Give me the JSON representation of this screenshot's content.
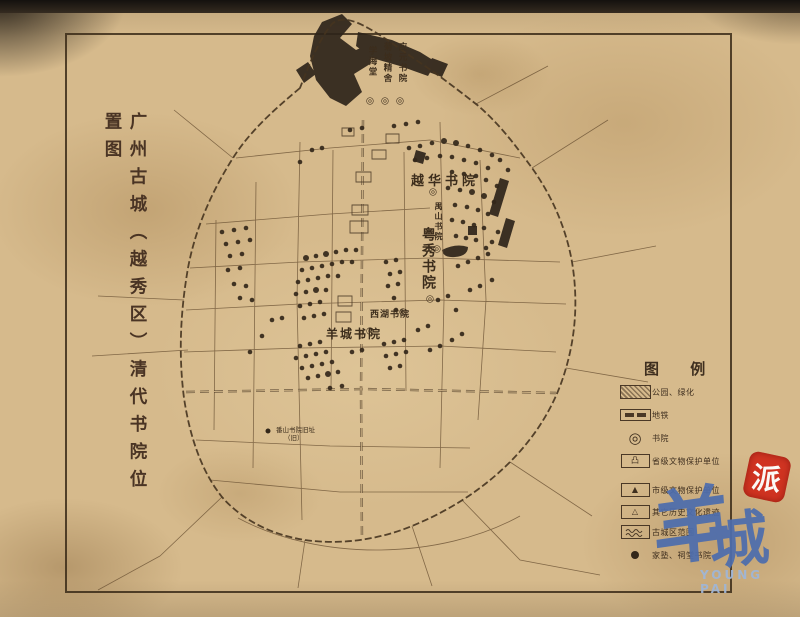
{
  "title": {
    "text": "广州古城（越秀区）清代书院位置图"
  },
  "legend": {
    "title": "图 例",
    "items": [
      {
        "symbol": "greenery",
        "label": "公园、绿化"
      },
      {
        "symbol": "metro",
        "label": "地铁"
      },
      {
        "symbol": "academy-ring",
        "label": "书院"
      },
      {
        "symbol": "provincial",
        "label": "省级文物保护单位",
        "glyph": "凸"
      },
      {
        "symbol": "municipal",
        "label": "市级文物保护单位",
        "glyph": "▲"
      },
      {
        "symbol": "other-relic",
        "label": "其它历史文化遗迹",
        "glyph": "△"
      },
      {
        "symbol": "old-city-wall",
        "label": "古城区范围"
      },
      {
        "symbol": "dot",
        "label": "家塾、祠堂书院"
      }
    ]
  },
  "watermark": {
    "cn_1": "羊",
    "cn_2": "城",
    "seal": "派",
    "en": "YOUNG PAI"
  },
  "map": {
    "marker_glyph": "◎",
    "academies": [
      {
        "name": "学海堂",
        "x": 366,
        "y": 46,
        "vertical": true,
        "size": 8.5,
        "marker": [
          370,
          101
        ]
      },
      {
        "name": "菊坡精舍",
        "x": 381,
        "y": 42,
        "vertical": true,
        "size": 8.5,
        "marker": [
          385,
          101
        ]
      },
      {
        "name": "应元书院",
        "x": 396,
        "y": 42,
        "vertical": true,
        "size": 8.5,
        "marker": [
          400,
          101
        ]
      },
      {
        "name": "越华书院",
        "x": 411,
        "y": 170,
        "vertical": false,
        "size": 13,
        "spacing": 4,
        "marker": [
          433,
          192
        ]
      },
      {
        "name": "禺山书院",
        "x": 434,
        "y": 202,
        "vertical": true,
        "size": 8,
        "marker": [
          437,
          249
        ]
      },
      {
        "name": "粤秀书院",
        "x": 418,
        "y": 227,
        "vertical": true,
        "size": 14,
        "marker": [
          430,
          299
        ]
      },
      {
        "name": "西湖书院",
        "x": 370,
        "y": 307,
        "vertical": false,
        "size": 9,
        "spacing": 1,
        "marker": [
          403,
          312
        ]
      },
      {
        "name": "羊城书院",
        "x": 326,
        "y": 325,
        "vertical": false,
        "size": 12,
        "spacing": 2,
        "marker": [
          370,
          331
        ]
      }
    ],
    "annotation": {
      "dot": [
        268,
        431
      ],
      "x": 276,
      "y": 426,
      "line1": "番山书院旧址",
      "line2": "（旧）"
    },
    "paths": {
      "wall": "M300,88 C280,105 252,128 233,158 C214,188 196,225 188,268 C181,308 178,352 184,398 C190,438 202,472 222,497 C242,520 272,535 305,540 C340,545 378,540 412,526 C446,512 480,492 510,462 C536,436 556,404 566,368 C576,334 578,298 572,262 C566,228 552,196 532,168 C516,146 498,122 476,104 C458,90 440,76 422,64 C404,52 386,38 368,28 C354,20 340,16 332,24 C320,38 310,62 300,88 Z",
      "roads": "M300,142 L297,300 L302,520 M440,122 L444,300 L440,468 M404,152 L406,391 M256,182 L253,468 M333,150 L331,391 M480,160 L486,300 L478,420 M216,220 L214,430 M236,158 L330,148 L430,140 L520,158 M206,224 L330,214 L430,208 M190,268 L300,262 L430,258 L560,262 M186,310 L300,304 L440,300 L566,304 M184,352 L300,348 L440,346 L556,352 M196,440 L330,446 L470,448 M210,480 L340,492 L468,492 M222,497 L160,556 M160,556 L98,590 M305,540 L298,588 M412,526 L432,586 M462,500 L520,560 L600,575 M510,462 L592,516 M566,368 L648,382 M572,262 L656,246 M532,168 L608,120 M476,104 L548,66 M233,158 L174,110 M184,300 L98,296 M188,350 L92,356 M238,518 C320,562 440,560 520,516",
      "metro": "M186,392 L364,389 L556,393 M363,120 L361,392 L362,540",
      "blobs": "M322,22 L342,14 L352,24 L340,38 L356,50 L374,42 L370,64 L354,74 L362,92 L346,106 L330,98 L316,80 L310,56 L314,36 Z M358,32 L392,40 L420,52 L436,62 L428,76 L400,66 L372,58 L356,46 Z M432,58 l16,6 l-6,13 l-16,-6 Z M296,70 l12,-8 l8,12 l-12,9 Z M500,178 l9,3 l-11,36 l-9,-3 Z M506,218 l9,3 l-8,27 l-9,-3 Z M442,250 q14,-7 26,-3 q0,9 -13,10 q-12,1 -13,-7 Z M468,226 h9 v9 h-9 Z M416,150 l10,3 l-3,11 l-10,-3 Z",
      "blocks": "M352,205 h16 v10 h-16 Z M350,221 h18 v12 h-18 Z M372,150 h14 v9 h-14 Z M342,128 h12 v8 h-12 Z M386,134 h13 v9 h-13 Z M356,172 h15 v10 h-15 Z M338,296 h14 v10 h-14 Z M336,312 h15 v10 h-15 Z"
    },
    "dots": [
      [
        409,
        148
      ],
      [
        420,
        146
      ],
      [
        432,
        143
      ],
      [
        444,
        141,
        3
      ],
      [
        456,
        143,
        3
      ],
      [
        468,
        146
      ],
      [
        480,
        150
      ],
      [
        492,
        155
      ],
      [
        415,
        160
      ],
      [
        427,
        158
      ],
      [
        440,
        156
      ],
      [
        452,
        157
      ],
      [
        464,
        160
      ],
      [
        476,
        163
      ],
      [
        488,
        168
      ],
      [
        452,
        172
      ],
      [
        464,
        174
      ],
      [
        476,
        176
      ],
      [
        486,
        180
      ],
      [
        497,
        186
      ],
      [
        448,
        188
      ],
      [
        460,
        190
      ],
      [
        472,
        192,
        3
      ],
      [
        484,
        196,
        3
      ],
      [
        494,
        202
      ],
      [
        455,
        205
      ],
      [
        467,
        207
      ],
      [
        478,
        210
      ],
      [
        488,
        214
      ],
      [
        452,
        220
      ],
      [
        463,
        222
      ],
      [
        474,
        225
      ],
      [
        484,
        228
      ],
      [
        456,
        236
      ],
      [
        466,
        238
      ],
      [
        476,
        240
      ],
      [
        498,
        232
      ],
      [
        492,
        242
      ],
      [
        486,
        248
      ],
      [
        500,
        160
      ],
      [
        508,
        170
      ],
      [
        350,
        130
      ],
      [
        362,
        128
      ],
      [
        394,
        126
      ],
      [
        406,
        124
      ],
      [
        418,
        122
      ],
      [
        312,
        150
      ],
      [
        322,
        148
      ],
      [
        300,
        162
      ],
      [
        306,
        258,
        3
      ],
      [
        316,
        256
      ],
      [
        326,
        254,
        3
      ],
      [
        336,
        252
      ],
      [
        346,
        250
      ],
      [
        356,
        250
      ],
      [
        302,
        270
      ],
      [
        312,
        268
      ],
      [
        322,
        266
      ],
      [
        332,
        264
      ],
      [
        342,
        262
      ],
      [
        352,
        262
      ],
      [
        386,
        262
      ],
      [
        396,
        260
      ],
      [
        298,
        282
      ],
      [
        308,
        280
      ],
      [
        318,
        278
      ],
      [
        328,
        276
      ],
      [
        338,
        276
      ],
      [
        390,
        274
      ],
      [
        400,
        272
      ],
      [
        296,
        294
      ],
      [
        306,
        292
      ],
      [
        316,
        290,
        3
      ],
      [
        326,
        290
      ],
      [
        388,
        286
      ],
      [
        398,
        284
      ],
      [
        300,
        306
      ],
      [
        310,
        304
      ],
      [
        320,
        302
      ],
      [
        394,
        298
      ],
      [
        304,
        318
      ],
      [
        314,
        316
      ],
      [
        324,
        314
      ],
      [
        396,
        310
      ],
      [
        222,
        232
      ],
      [
        234,
        230
      ],
      [
        246,
        228
      ],
      [
        226,
        244
      ],
      [
        238,
        242
      ],
      [
        250,
        240
      ],
      [
        230,
        256
      ],
      [
        242,
        254
      ],
      [
        228,
        270
      ],
      [
        240,
        268
      ],
      [
        234,
        284
      ],
      [
        246,
        286
      ],
      [
        252,
        300
      ],
      [
        240,
        298
      ],
      [
        300,
        346
      ],
      [
        310,
        344
      ],
      [
        320,
        342
      ],
      [
        296,
        358
      ],
      [
        306,
        356
      ],
      [
        316,
        354
      ],
      [
        326,
        352
      ],
      [
        302,
        368
      ],
      [
        312,
        366
      ],
      [
        322,
        364
      ],
      [
        332,
        362
      ],
      [
        308,
        378
      ],
      [
        318,
        376
      ],
      [
        328,
        374,
        3
      ],
      [
        338,
        372
      ],
      [
        330,
        388
      ],
      [
        342,
        386
      ],
      [
        352,
        352
      ],
      [
        362,
        350
      ],
      [
        384,
        344
      ],
      [
        394,
        342
      ],
      [
        404,
        340
      ],
      [
        386,
        356
      ],
      [
        396,
        354
      ],
      [
        406,
        352
      ],
      [
        390,
        368
      ],
      [
        400,
        366
      ],
      [
        272,
        320
      ],
      [
        282,
        318
      ],
      [
        262,
        336
      ],
      [
        250,
        352
      ],
      [
        438,
        300
      ],
      [
        448,
        296
      ],
      [
        456,
        310
      ],
      [
        418,
        330
      ],
      [
        428,
        326
      ],
      [
        470,
        290
      ],
      [
        480,
        286
      ],
      [
        492,
        280
      ],
      [
        458,
        266
      ],
      [
        468,
        262
      ],
      [
        478,
        258
      ],
      [
        488,
        254
      ],
      [
        430,
        350
      ],
      [
        440,
        346
      ],
      [
        452,
        340
      ],
      [
        462,
        334
      ]
    ]
  }
}
